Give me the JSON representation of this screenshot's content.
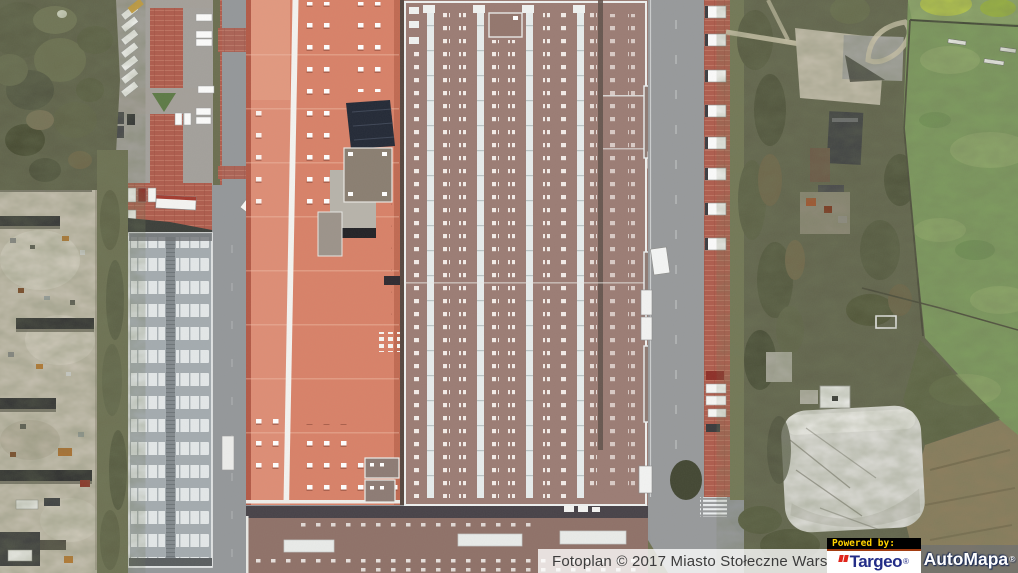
{
  "map": {
    "description": "Aerial orthophoto of an industrial complex: large orange-roofed hall, grey skylighted production halls, long warehouse, parking lots with white vans and trucks, junkyard, wooded strip, white storage dome and a sports field."
  },
  "attribution": {
    "text": "Fotoplan © 2017 Miasto Stołeczne Warszawa"
  },
  "logos": {
    "powered_by": "Powered by:",
    "targeo": {
      "name": "Targeo",
      "registered": "®"
    },
    "automapa": {
      "name": "AutoMapa",
      "registered": "®"
    }
  },
  "colors": {
    "attribution_text": "#3c3c3c",
    "attribution_bg": "rgba(255,255,255,0.78)",
    "powered_by_text": "#ffd200",
    "powered_by_bg": "#000000",
    "targeo_text": "#232d87",
    "targeo_mark": "#e0251b",
    "targeo_bg": "#ffffff",
    "automapa_text": "#ffffff",
    "automapa_outline": "#1a2a55",
    "orange_roof": "#d88168",
    "hall_roof": "#9b7c74",
    "warehouse_roof": "#a4abaf",
    "road": "#94979a",
    "brick_paving": "#ae5c4d",
    "trees": "#61634c",
    "field_green": "#7d9b5e",
    "dirt": "#8d7d5d",
    "dome_white": "#e0dfdb"
  }
}
